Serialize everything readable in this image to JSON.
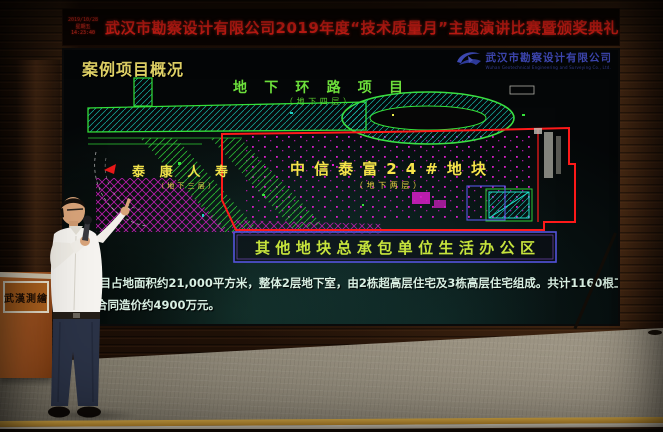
{
  "led_banner": {
    "date": "2019/10/28",
    "weekday": "星期五",
    "time": "14:23:40",
    "title": "武汉市勘察设计有限公司2019年度“技术质量月”主题演讲比赛暨颁奖典礼",
    "text_color": "#ff241a"
  },
  "slide": {
    "title": "案例项目概况",
    "logo": {
      "company_cn": "武汉市勘察设计有限公司",
      "company_en": "Wuhan Geotechnical Engineering and Surveying Co., Ltd."
    },
    "cad": {
      "label_ring_road": "地下环路项目",
      "label_ring_road_sub": "（地下四层）",
      "label_taikang": "泰康人寿",
      "label_taikang_sub": "（地下三层）",
      "label_citic": "中信泰富24#地块",
      "label_citic_sub": "（地下两层）",
      "label_office": "其他地块总承包单位生活办公区",
      "colors": {
        "green": "#35e03a",
        "yellow": "#f6e44a",
        "magenta": "#d81ec8",
        "red": "#ff1a1a",
        "cyan": "#20d0c0",
        "box_blue": "#5454dc"
      }
    },
    "description_line1": "项目占地面积约21,000平方米，整体2层地下室，由2栋超高层住宅及3栋高层住宅组成。共计1160根工程",
    "description_line2": "合同造价约4900万元。"
  },
  "podium": {
    "calligraphy": "武漢測繪"
  }
}
